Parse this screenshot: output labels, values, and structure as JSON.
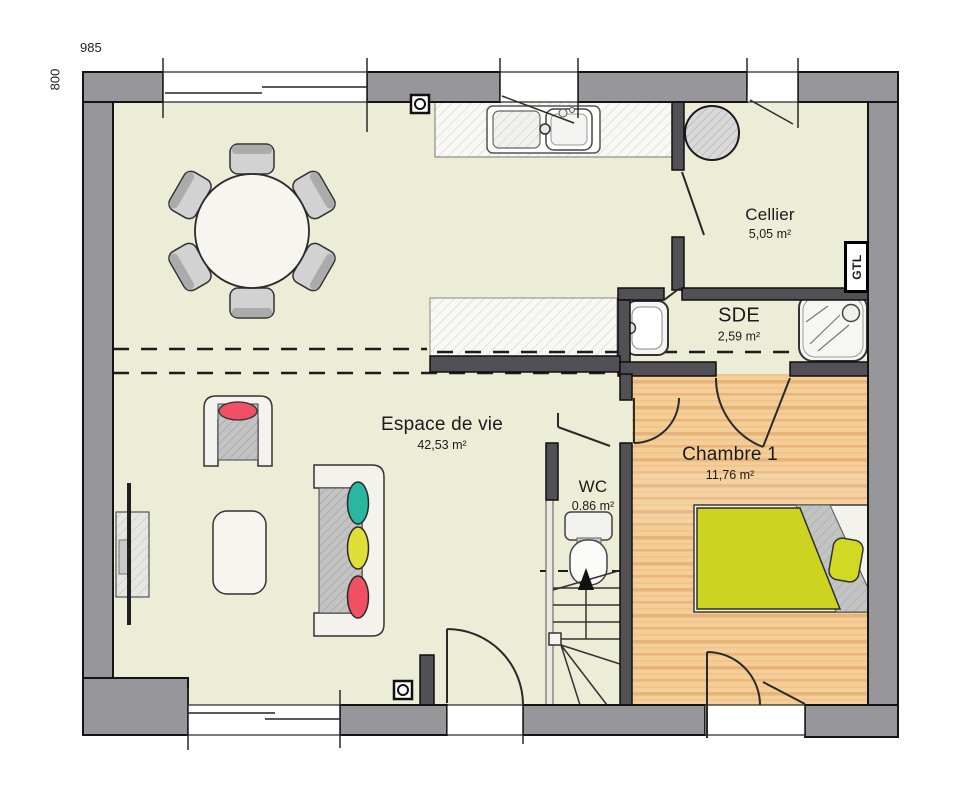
{
  "plan": {
    "dimensions": {
      "width": "985",
      "height": "800"
    },
    "rooms": {
      "living": {
        "name": "Espace de vie",
        "area": "42,53 m²"
      },
      "cellier": {
        "name": "Cellier",
        "area": "5,05 m²"
      },
      "sde": {
        "name": "SDE",
        "area": "2,59 m²"
      },
      "wc": {
        "name": "WC",
        "area": "0.86 m²"
      },
      "bedroom": {
        "name": "Chambre 1",
        "area": "11,76 m²"
      }
    },
    "labels": {
      "gtl": "GTL"
    },
    "colors": {
      "floor": "#ecedd7",
      "wood": "#f4cd97",
      "outer_wall": "#97979b",
      "inner_wall": "#515155",
      "cushion_teal": "#29b7a2",
      "cushion_yellow": "#e0df3a",
      "cushion_red": "#ef5063",
      "duvet_yellow": "#ccd320"
    },
    "furniture_icons": [
      "dining-table-icon",
      "dining-chair-icon",
      "kitchen-sink-icon",
      "water-heater-icon",
      "island-counter-icon",
      "washbasin-icon",
      "shower-icon",
      "toilet-icon",
      "stairs-icon",
      "bed-icon",
      "sofa-icon",
      "armchair-icon",
      "coffee-table-icon",
      "tv-unit-icon"
    ]
  }
}
